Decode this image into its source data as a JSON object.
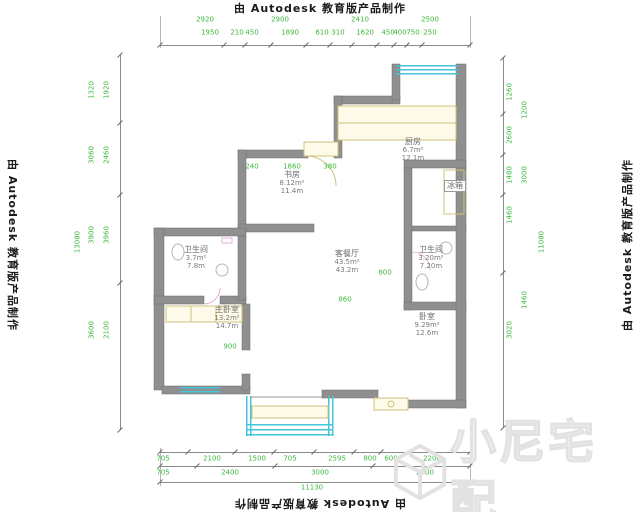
{
  "watermarks": {
    "autodesk": "由 Autodesk 教育版产品制作",
    "brand": "小尼宅配"
  },
  "colors": {
    "wall": "#8f8f8f",
    "window": "#45c6d8",
    "fixture": "#cfc37a",
    "dimension_text": "#3db83d",
    "door_arc_pink": "#df9fd8",
    "watermark_gray": "#e2e2e2"
  },
  "rooms": [
    {
      "name": "书房",
      "area": "8.12m²",
      "perimeter": "11.4m"
    },
    {
      "name": "厨房",
      "area": "6.7m²",
      "perimeter": "12.1m"
    },
    {
      "name": "卫生间",
      "area": "3.7m²",
      "perimeter": "7.8m"
    },
    {
      "name": "客餐厅",
      "area": "43.5m²",
      "perimeter": "43.2m"
    },
    {
      "name": "主卧室",
      "area": "13.2m²",
      "perimeter": "14.7m"
    },
    {
      "name": "卧室",
      "area": "9.29m²",
      "perimeter": "12.6m"
    },
    {
      "name": "卫生间",
      "area": "3.20m²",
      "perimeter": "7.20m"
    },
    {
      "name": "冰箱",
      "area": "",
      "perimeter": ""
    }
  ],
  "dimensions": {
    "top_row1": [
      "2920",
      "2900",
      "2410",
      "2500"
    ],
    "top_row2": [
      "1950",
      "210",
      "450",
      "1890",
      "610",
      "310",
      "1620",
      "450",
      "400",
      "750",
      "250"
    ],
    "bottom_row1": [
      "705",
      "2100",
      "1500",
      "705",
      "2595",
      "800",
      "600",
      "2200"
    ],
    "bottom_row2": [
      "705",
      "2400",
      "3000",
      "2600"
    ],
    "bottom_total": "11130",
    "left_colA": [
      "1320",
      "3060",
      "3900",
      "3600"
    ],
    "left_colB": [
      "1920",
      "2460",
      "3960",
      "2100"
    ],
    "left_total": "13080",
    "right_colA": [
      "1260",
      "2600",
      "1480",
      "1460",
      "3020"
    ],
    "right_colB": [
      "1200",
      "3000",
      "1460"
    ],
    "right_total": "11080",
    "interior": [
      "240",
      "1860",
      "380",
      "800",
      "900",
      "860"
    ]
  }
}
